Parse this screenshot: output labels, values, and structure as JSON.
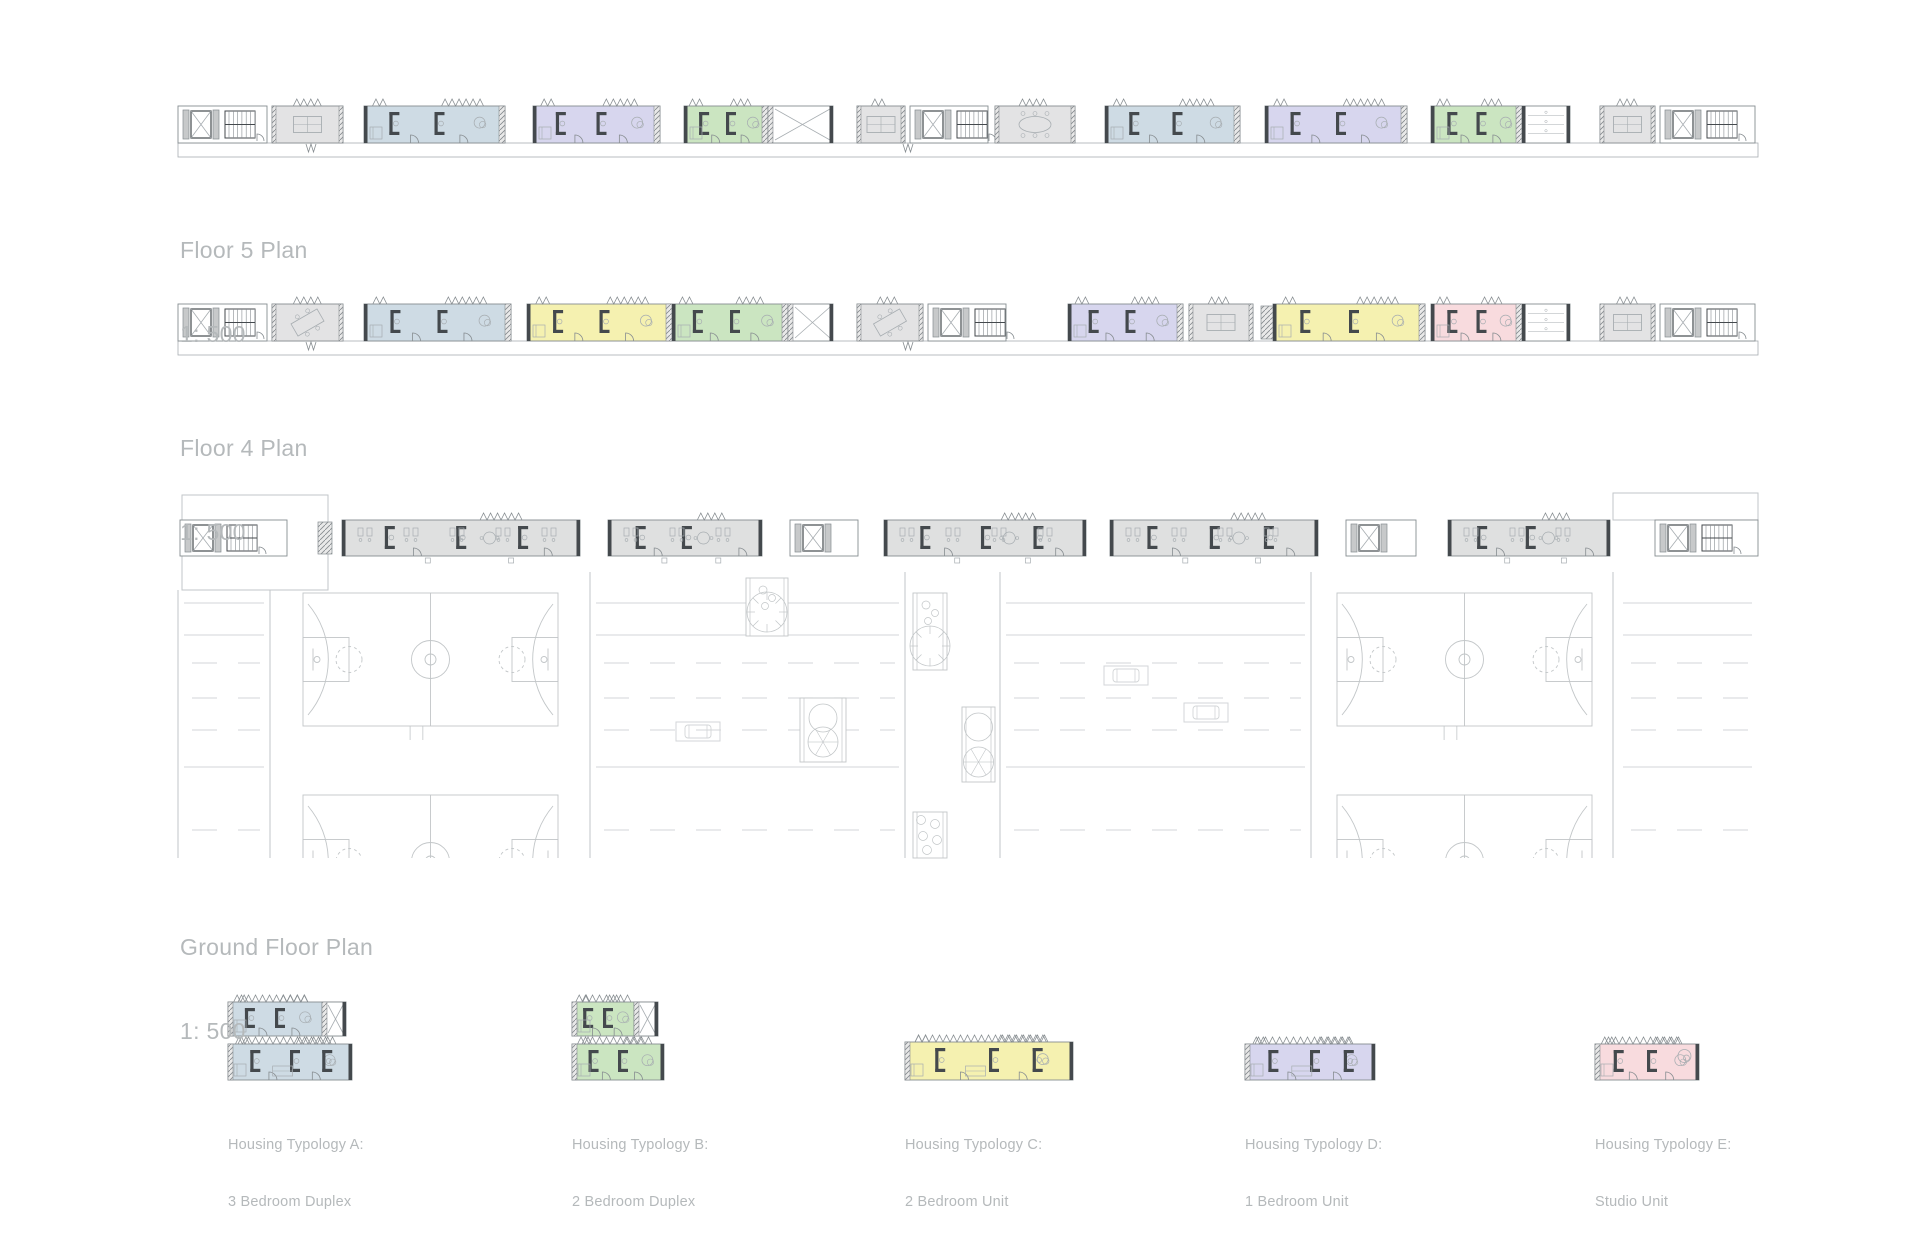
{
  "colors": {
    "bg": "#ffffff",
    "wall": "#44494d",
    "line": "#878d91",
    "mid": "#a7adb1",
    "faint": "#c2c6c8",
    "road": "#d3d6d8",
    "gray_room": "#e3e3e4",
    "gray_unit": "#dfe0e0",
    "blue": "#cedbe4",
    "green": "#cbe5c1",
    "yellow": "#f5f1b0",
    "purple": "#d7d6ee",
    "pink": "#f8dbde",
    "label": "#b5b9bb"
  },
  "labels": {
    "floor5": {
      "title": "Floor 5 Plan",
      "scale": "1: 500"
    },
    "floor4": {
      "title": "Floor 4 Plan",
      "scale": "1: 500"
    },
    "ground": {
      "title": "Ground Floor Plan",
      "scale": "1: 500"
    }
  },
  "strips": [
    {
      "name": "floor5",
      "y": 106,
      "h": 37,
      "band": 14,
      "x0": 178,
      "x1": 1758,
      "modules": [
        {
          "t": "core",
          "x": 178,
          "w": 89,
          "parts": [
            "elev",
            "stair"
          ]
        },
        {
          "t": "room",
          "x": 272,
          "w": 71,
          "table": "straight"
        },
        {
          "t": "unit",
          "x": 364,
          "w": 141,
          "c": "blue"
        },
        {
          "t": "unit",
          "x": 533,
          "w": 127,
          "c": "purple"
        },
        {
          "t": "unit",
          "x": 684,
          "w": 84,
          "c": "green"
        },
        {
          "t": "annex",
          "x": 768,
          "w": 65,
          "style": "x"
        },
        {
          "t": "room",
          "x": 857,
          "w": 48,
          "table": "straight"
        },
        {
          "t": "core",
          "x": 910,
          "w": 78,
          "parts": [
            "elev",
            "stair"
          ]
        },
        {
          "t": "room",
          "x": 995,
          "w": 80,
          "table": "meeting"
        },
        {
          "t": "unit",
          "x": 1105,
          "w": 135,
          "c": "blue"
        },
        {
          "t": "unit",
          "x": 1265,
          "w": 142,
          "c": "purple"
        },
        {
          "t": "unit",
          "x": 1431,
          "w": 91,
          "c": "green"
        },
        {
          "t": "annex",
          "x": 1522,
          "w": 48,
          "style": "shelf"
        },
        {
          "t": "room",
          "x": 1600,
          "w": 55,
          "table": "straight"
        },
        {
          "t": "core",
          "x": 1660,
          "w": 95,
          "parts": [
            "elev",
            "stair"
          ]
        }
      ]
    },
    {
      "name": "floor4",
      "y": 304,
      "h": 37,
      "band": 14,
      "x0": 178,
      "x1": 1758,
      "modules": [
        {
          "t": "core",
          "x": 178,
          "w": 89,
          "parts": [
            "elev",
            "stair"
          ]
        },
        {
          "t": "room",
          "x": 272,
          "w": 71,
          "table": "angled"
        },
        {
          "t": "unit",
          "x": 364,
          "w": 147,
          "c": "blue"
        },
        {
          "t": "unit",
          "x": 527,
          "w": 145,
          "c": "yellow"
        },
        {
          "t": "unit",
          "x": 672,
          "w": 116,
          "c": "green"
        },
        {
          "t": "annex",
          "x": 788,
          "w": 45,
          "style": "x"
        },
        {
          "t": "room",
          "x": 857,
          "w": 66,
          "table": "angled"
        },
        {
          "t": "core",
          "x": 928,
          "w": 78,
          "parts": [
            "elev",
            "stair"
          ]
        },
        {
          "t": "unit",
          "x": 1068,
          "w": 115,
          "c": "purple"
        },
        {
          "t": "room",
          "x": 1189,
          "w": 64,
          "table": "straight"
        },
        {
          "t": "vhatch",
          "x": 1261,
          "w": 12
        },
        {
          "t": "unit",
          "x": 1273,
          "w": 152,
          "c": "yellow"
        },
        {
          "t": "unit",
          "x": 1431,
          "w": 91,
          "c": "pink"
        },
        {
          "t": "annex",
          "x": 1522,
          "w": 48,
          "style": "shelf"
        },
        {
          "t": "room",
          "x": 1600,
          "w": 55,
          "table": "straight"
        },
        {
          "t": "core",
          "x": 1660,
          "w": 95,
          "parts": [
            "elev",
            "stair"
          ]
        }
      ]
    },
    {
      "name": "ground",
      "y": 520,
      "h": 36,
      "band": 0,
      "x0": 178,
      "x1": 1758,
      "modules": [
        {
          "t": "core",
          "x": 180,
          "w": 107,
          "parts": [
            "elev",
            "stair"
          ]
        },
        {
          "t": "vhatch",
          "x": 318,
          "w": 14
        },
        {
          "t": "comm",
          "x": 342,
          "w": 238
        },
        {
          "t": "comm",
          "x": 608,
          "w": 154
        },
        {
          "t": "core",
          "x": 790,
          "w": 68,
          "parts": [
            "elev"
          ]
        },
        {
          "t": "comm",
          "x": 884,
          "w": 202
        },
        {
          "t": "comm",
          "x": 1110,
          "w": 208
        },
        {
          "t": "core",
          "x": 1346,
          "w": 70,
          "parts": [
            "elev"
          ]
        },
        {
          "t": "comm",
          "x": 1448,
          "w": 162
        },
        {
          "t": "core",
          "x": 1655,
          "w": 103,
          "parts": [
            "elev",
            "stair"
          ]
        }
      ]
    }
  ],
  "site": {
    "parapets": [
      {
        "x": 182,
        "y": 495,
        "w": 146,
        "h": 95
      },
      {
        "x": 1613,
        "y": 493,
        "w": 145,
        "h": 27
      }
    ],
    "verticals": [
      [
        270,
        590,
        858
      ],
      [
        590,
        572,
        858
      ],
      [
        905,
        572,
        858
      ],
      [
        1000,
        572,
        858
      ],
      [
        1311,
        572,
        858
      ],
      [
        1613,
        572,
        858
      ],
      [
        178,
        590,
        858
      ]
    ],
    "hlines": [
      [
        182,
        270,
        590
      ]
    ],
    "road_segments": [
      [
        178,
        270
      ],
      [
        590,
        905
      ],
      [
        1000,
        1311
      ],
      [
        1617,
        1758
      ]
    ],
    "road_solid_y": [
      603,
      635,
      767
    ],
    "road_dash_y": [
      663,
      698,
      730,
      830
    ],
    "courts": [
      {
        "x": 303,
        "y": 593
      },
      {
        "x": 1337,
        "y": 593
      },
      {
        "x": 303,
        "y": 795
      },
      {
        "x": 1337,
        "y": 795
      }
    ],
    "court_w": 255,
    "court_h": 133,
    "clip_y": 858,
    "planters": [
      {
        "x": 746,
        "y": 578,
        "w": 42,
        "h": 58,
        "kind": "tree"
      },
      {
        "x": 800,
        "y": 698,
        "w": 46,
        "h": 64,
        "kind": "tree2"
      },
      {
        "x": 913,
        "y": 593,
        "w": 34,
        "h": 77,
        "kind": "tree"
      },
      {
        "x": 962,
        "y": 707,
        "w": 33,
        "h": 75,
        "kind": "tree2"
      },
      {
        "x": 913,
        "y": 812,
        "w": 34,
        "h": 46,
        "kind": "bush"
      }
    ],
    "cars": [
      [
        676,
        722
      ],
      [
        1104,
        666
      ],
      [
        1184,
        703
      ]
    ]
  },
  "typologies": [
    {
      "id": "A",
      "color": "blue",
      "lines": [
        "Housing Typology A:",
        "3 Bedroom Duplex"
      ],
      "lx": 228,
      "plans": [
        {
          "x": 228,
          "y": 1002,
          "w": 118,
          "h": 34,
          "annex": true
        },
        {
          "x": 228,
          "y": 1044,
          "w": 124,
          "h": 36
        }
      ]
    },
    {
      "id": "B",
      "color": "green",
      "lines": [
        "Housing Typology B:",
        "2 Bedroom Duplex"
      ],
      "lx": 572,
      "plans": [
        {
          "x": 572,
          "y": 1002,
          "w": 86,
          "h": 34,
          "annex": true
        },
        {
          "x": 572,
          "y": 1044,
          "w": 92,
          "h": 36
        }
      ]
    },
    {
      "id": "C",
      "color": "yellow",
      "lines": [
        "Housing Typology C:",
        "2 Bedroom Unit"
      ],
      "lx": 905,
      "plans": [
        {
          "x": 905,
          "y": 1042,
          "w": 168,
          "h": 38
        }
      ]
    },
    {
      "id": "D",
      "color": "purple",
      "lines": [
        "Housing Typology D:",
        "1 Bedroom Unit"
      ],
      "lx": 1245,
      "plans": [
        {
          "x": 1245,
          "y": 1044,
          "w": 130,
          "h": 36
        }
      ]
    },
    {
      "id": "E",
      "color": "pink",
      "lines": [
        "Housing Typology E:",
        "Studio Unit"
      ],
      "lx": 1595,
      "plans": [
        {
          "x": 1595,
          "y": 1044,
          "w": 104,
          "h": 36,
          "spiral": true
        }
      ]
    }
  ]
}
